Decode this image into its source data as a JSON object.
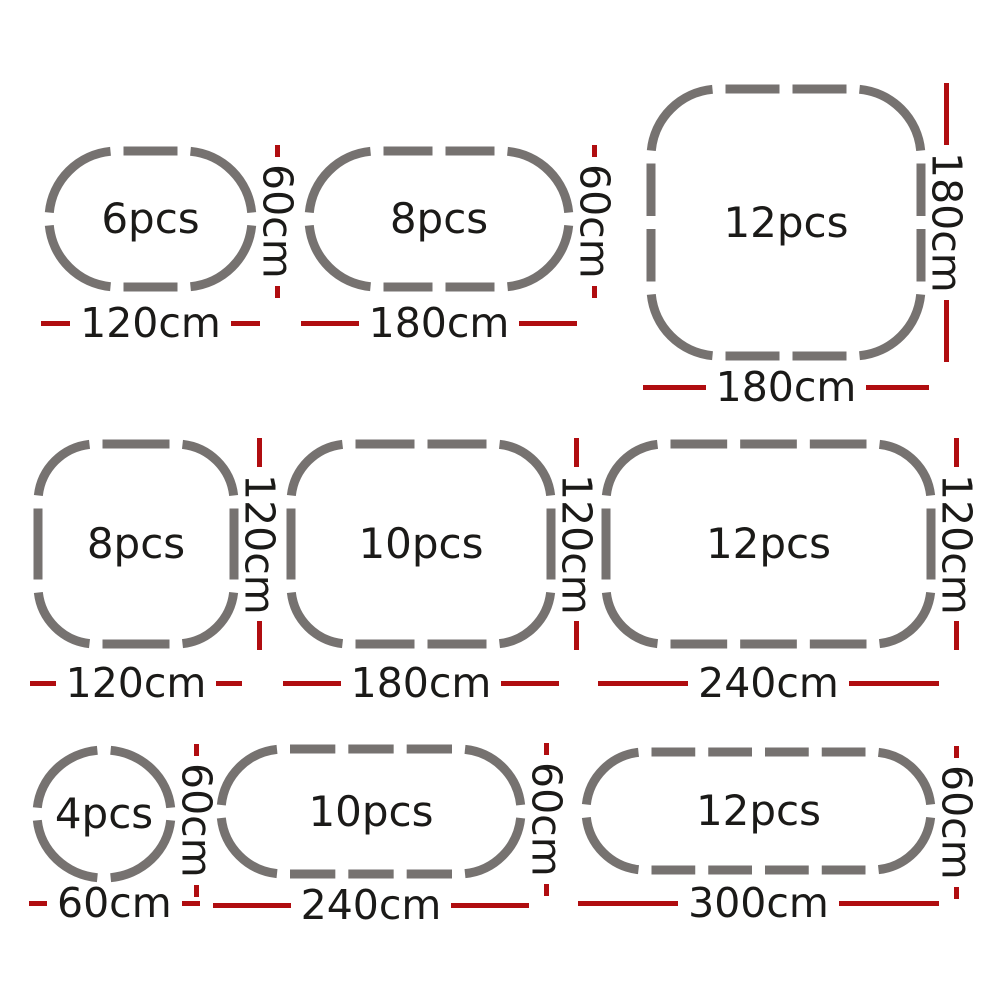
{
  "colors": {
    "panel_gray": "#767270",
    "dimension_red": "#b00d10",
    "label_black": "#1b1a18",
    "background": "#ffffff"
  },
  "shapes": [
    {
      "pcs_label": "6pcs",
      "pieces": 6,
      "width_label": "120cm",
      "height_label": "60cm",
      "width_cm": 120,
      "height_cm": 60,
      "type": "stadium",
      "top_dashes": 1,
      "side_dashes": 0
    },
    {
      "pcs_label": "8pcs",
      "pieces": 8,
      "width_label": "180cm",
      "height_label": "60cm",
      "width_cm": 180,
      "height_cm": 60,
      "type": "stadium",
      "top_dashes": 2,
      "side_dashes": 0
    },
    {
      "pcs_label": "12pcs",
      "pieces": 12,
      "width_label": "180cm",
      "height_label": "180cm",
      "width_cm": 180,
      "height_cm": 180,
      "type": "rounded-square",
      "top_dashes": 2,
      "side_dashes": 2
    },
    {
      "pcs_label": "8pcs",
      "pieces": 8,
      "width_label": "120cm",
      "height_label": "120cm",
      "width_cm": 120,
      "height_cm": 120,
      "type": "rounded-square",
      "top_dashes": 1,
      "side_dashes": 1
    },
    {
      "pcs_label": "10pcs",
      "pieces": 10,
      "width_label": "180cm",
      "height_label": "120cm",
      "width_cm": 180,
      "height_cm": 120,
      "type": "rounded-rect",
      "top_dashes": 2,
      "side_dashes": 1
    },
    {
      "pcs_label": "12pcs",
      "pieces": 12,
      "width_label": "240cm",
      "height_label": "120cm",
      "width_cm": 240,
      "height_cm": 120,
      "type": "rounded-rect",
      "top_dashes": 3,
      "side_dashes": 1
    },
    {
      "pcs_label": "4pcs",
      "pieces": 4,
      "width_label": "60cm",
      "height_label": "60cm",
      "width_cm": 60,
      "height_cm": 60,
      "type": "circle",
      "top_dashes": 0,
      "side_dashes": 0
    },
    {
      "pcs_label": "10pcs",
      "pieces": 10,
      "width_label": "240cm",
      "height_label": "60cm",
      "width_cm": 240,
      "height_cm": 60,
      "type": "stadium",
      "top_dashes": 3,
      "side_dashes": 0
    },
    {
      "pcs_label": "12pcs",
      "pieces": 12,
      "width_label": "300cm",
      "height_label": "60cm",
      "width_cm": 300,
      "height_cm": 60,
      "type": "stadium",
      "top_dashes": 4,
      "side_dashes": 0
    }
  ]
}
